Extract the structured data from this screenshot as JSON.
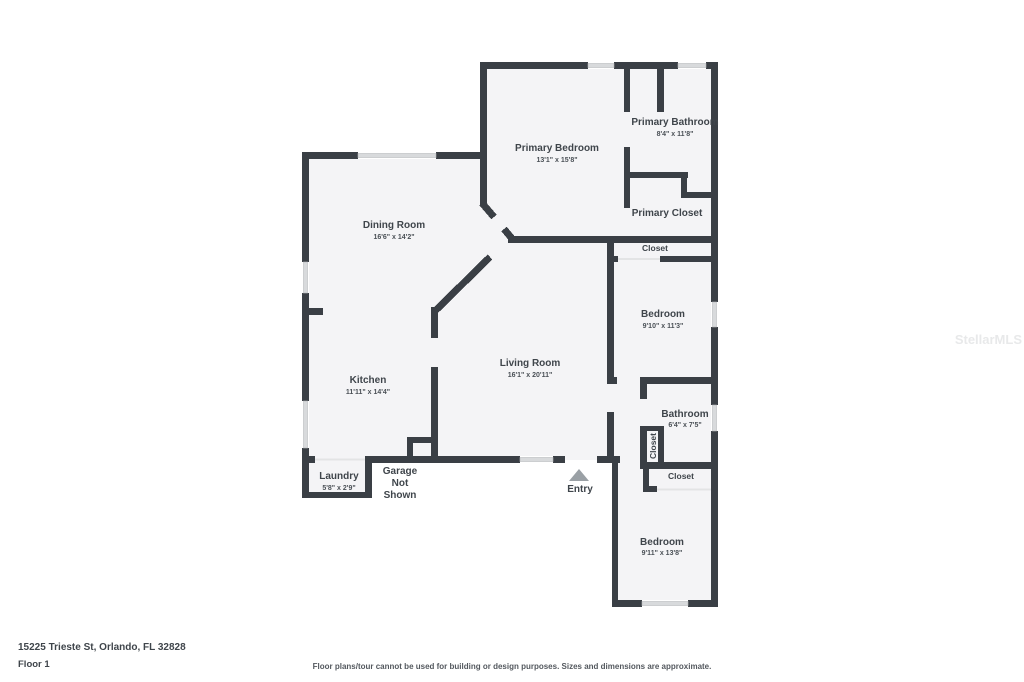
{
  "rooms": {
    "primary_bedroom": {
      "name": "Primary Bedroom",
      "dims": "13'1\" x 15'8\""
    },
    "primary_bathroom": {
      "name": "Primary Bathroom",
      "dims": "8'4\" x 11'8\""
    },
    "primary_closet": {
      "name": "Primary Closet"
    },
    "hall_closet": {
      "name": "Closet"
    },
    "dining_room": {
      "name": "Dining Room",
      "dims": "16'6\" x 14'2\""
    },
    "kitchen": {
      "name": "Kitchen",
      "dims": "11'11\" x 14'4\""
    },
    "living_room": {
      "name": "Living Room",
      "dims": "16'1\" x 20'11\""
    },
    "bedroom_2": {
      "name": "Bedroom",
      "dims": "9'10\" x 11'3\""
    },
    "bathroom": {
      "name": "Bathroom",
      "dims": "6'4\" x 7'5\""
    },
    "bath_closet": {
      "name": "Closet"
    },
    "bedroom_3_closet": {
      "name": "Closet"
    },
    "bedroom_3": {
      "name": "Bedroom",
      "dims": "9'11\" x 13'8\""
    },
    "laundry": {
      "name": "Laundry",
      "dims": "5'8\" x 2'9\""
    },
    "garage": {
      "lines": [
        "Garage",
        "Not",
        "Shown"
      ]
    },
    "entry": {
      "name": "Entry"
    }
  },
  "footer": {
    "address": "15225 Trieste St, Orlando, FL 32828",
    "floor": "Floor 1",
    "disclaimer": "Floor plans/tour cannot be used for building or design purposes. Sizes and dimensions are approximate."
  },
  "watermark": "StellarMLS",
  "colors": {
    "wall": "#3a3f45",
    "room_fill": "#f4f4f6",
    "window": "#d8dadc",
    "text": "#3f454b"
  }
}
